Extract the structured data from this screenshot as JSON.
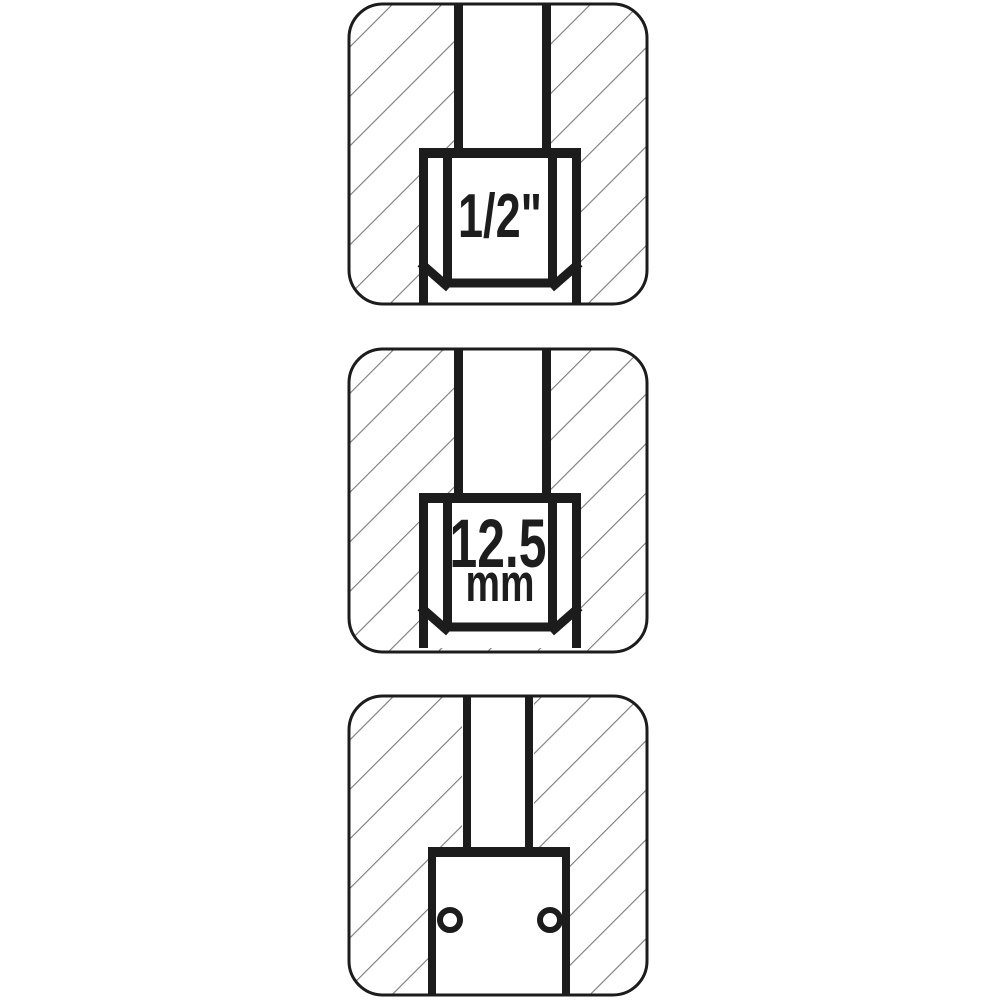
{
  "figure": {
    "title": "socket-drive-size-diagram",
    "panels": [
      {
        "id": "drive-size-inch",
        "view": "socket-cross-section-with-square-drive-tang",
        "label": "1/2\""
      },
      {
        "id": "drive-size-metric",
        "view": "socket-cross-section-with-square-drive-tang",
        "value": "12.5",
        "unit": "mm"
      },
      {
        "id": "drive-pin-hole-view",
        "view": "socket-side-cross-section",
        "hole_count": 2
      }
    ]
  },
  "colors": {
    "line": "#1c1c1c",
    "hatch": "#7d7d7d",
    "background": "#ffffff"
  }
}
